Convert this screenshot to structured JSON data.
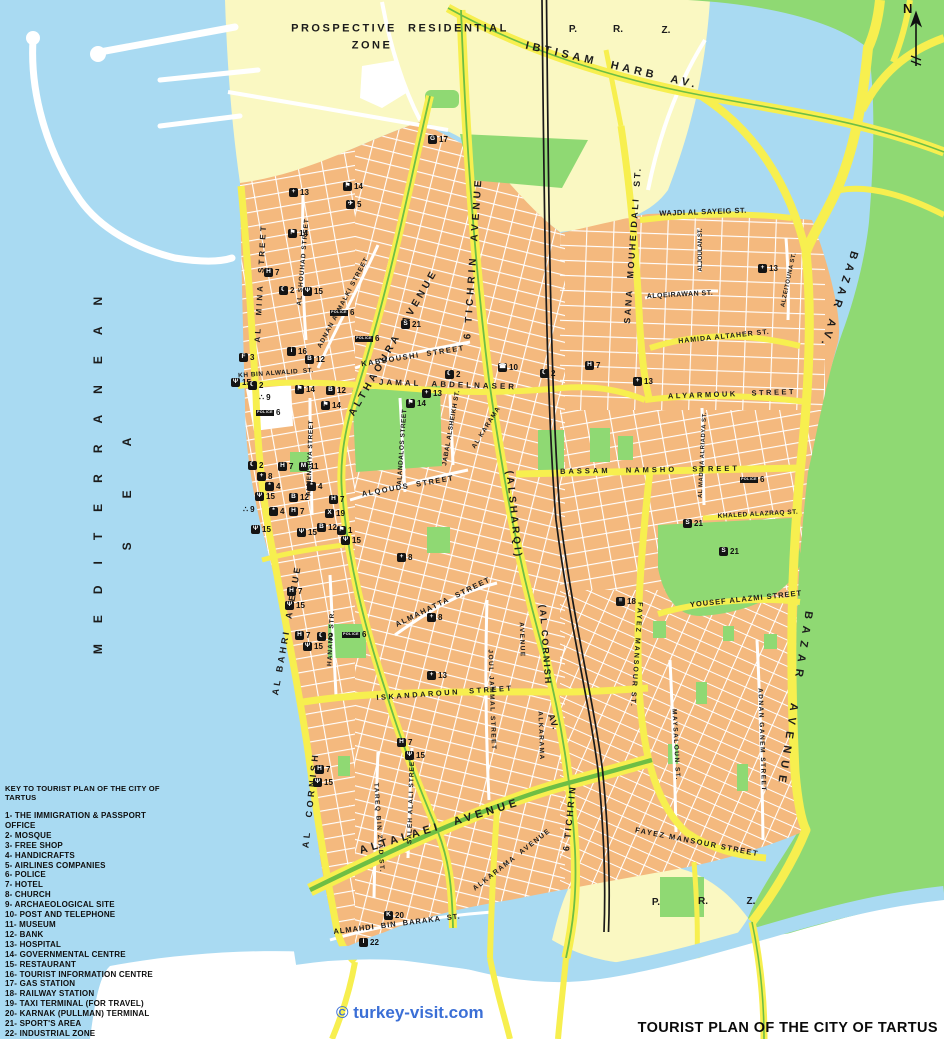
{
  "title": "TOURIST PLAN OF THE CITY OF TARTUS",
  "watermark": "© turkey-visit.com",
  "compass": "N",
  "colors": {
    "sea": "#A9DAF2",
    "sand": "#FAF8C2",
    "green": "#8FD973",
    "city": "#F4B97E",
    "road": "#F7EF4F",
    "median": "#6EBE44",
    "rail": "#1a1a1a",
    "street": "#FFFFFF",
    "watermark": "#3B6FD6"
  },
  "legend": {
    "title": "KEY TO TOURIST PLAN OF THE CITY OF TARTUS",
    "items": [
      "1- THE  IMMIGRATION  &  PASSPORT OFFICE",
      "2- MOSQUE",
      "3- FREE SHOP",
      "4- HANDICRAFTS",
      "5- AIRLINES COMPANIES",
      "6- POLICE",
      "7- HOTEL",
      "8- CHURCH",
      "9- ARCHAEOLOGICAL SITE",
      "10-  POST AND TELEPHONE",
      "11- MUSEUM",
      "12- BANK",
      "13- HOSPITAL",
      "14- GOVERNMENTAL CENTRE",
      "15- RESTAURANT",
      "16- TOURIST INFORMATION CENTRE",
      "17- GAS STATION",
      "18- RAILWAY STATION",
      "19- TAXI TERMINAL (FOR TRAVEL)",
      "20- KARNAK (PULLMAN) TERMINAL",
      "21- SPORT'S AREA",
      "22- INDUSTRIAL ZONE"
    ]
  },
  "poi_glyphs": {
    "1": "⚑",
    "2": "☾",
    "3": "F",
    "4": "*",
    "5": "✈",
    "6": "POLICE",
    "7": "H",
    "8": "+",
    "9": "∴",
    "10": "☎",
    "11": "M",
    "12": "B",
    "13": "+",
    "14": "⚑",
    "15": "Ψ",
    "16": "i",
    "17": "G",
    "18": "≡",
    "19": "X",
    "20": "K",
    "21": "S",
    "22": "I"
  },
  "streets": [
    {
      "label": "PROSPECTIVE  RESIDENTIAL",
      "x": 400,
      "y": 29,
      "rot": 0,
      "fs": 11,
      "ls": 2.5
    },
    {
      "label": "ZONE",
      "x": 372,
      "y": 46,
      "rot": 0,
      "fs": 11,
      "ls": 2.5
    },
    {
      "label": "P.",
      "x": 573,
      "y": 30,
      "rot": 0,
      "fs": 10,
      "ls": 0
    },
    {
      "label": "R.",
      "x": 618,
      "y": 30,
      "rot": 0,
      "fs": 10,
      "ls": 0
    },
    {
      "label": "Z.",
      "x": 666,
      "y": 31,
      "rot": 0,
      "fs": 10,
      "ls": 0
    },
    {
      "label": "P.",
      "x": 656,
      "y": 903,
      "rot": 0,
      "fs": 10,
      "ls": 0
    },
    {
      "label": "R.",
      "x": 703,
      "y": 902,
      "rot": 0,
      "fs": 10,
      "ls": 0
    },
    {
      "label": "Z.",
      "x": 751,
      "y": 902,
      "rot": 0,
      "fs": 10,
      "ls": 0
    },
    {
      "label": "IBTISAM  HARB  AV.",
      "x": 612,
      "y": 66,
      "rot": 13,
      "fs": 11,
      "ls": 4
    },
    {
      "label": "MEDITERRANEAN",
      "x": 98,
      "y": 465,
      "rot": -90,
      "fs": 12,
      "ls": 21
    },
    {
      "label": "SEA",
      "x": 127,
      "y": 472,
      "rot": -90,
      "fs": 12,
      "ls": 44
    },
    {
      "label": "AL  MINA  STREET",
      "x": 261,
      "y": 283,
      "rot": -87,
      "fs": 8,
      "ls": 3
    },
    {
      "label": "AL SHOUHAD STREET",
      "x": 304,
      "y": 262,
      "rot": -85,
      "fs": 6.5,
      "ls": 1
    },
    {
      "label": "ADNAN ALMALKI STREET",
      "x": 344,
      "y": 303,
      "rot": -62,
      "fs": 6.5,
      "ls": 1
    },
    {
      "label": "ALTHAOURA  AVENUE",
      "x": 394,
      "y": 343,
      "rot": -60,
      "fs": 10,
      "ls": 3.5
    },
    {
      "label": "6 TICHRIN  AVENUE",
      "x": 474,
      "y": 258,
      "rot": -86,
      "fs": 10,
      "ls": 4
    },
    {
      "label": "SANA  MOUHEIDALI  ST.",
      "x": 633,
      "y": 245,
      "rot": -86,
      "fs": 9,
      "ls": 2.5
    },
    {
      "label": "WAJDI AL SAYEIG ST.",
      "x": 703,
      "y": 212,
      "rot": -2,
      "fs": 7.5,
      "ls": 0.5
    },
    {
      "label": "ALJOULAN ST.",
      "x": 701,
      "y": 250,
      "rot": -90,
      "fs": 6,
      "ls": 0
    },
    {
      "label": "ALQEIRAWAN ST.",
      "x": 680,
      "y": 295,
      "rot": -3,
      "fs": 7,
      "ls": 0.5
    },
    {
      "label": "HAMIDA ALTAHER ST.",
      "x": 724,
      "y": 337,
      "rot": -6,
      "fs": 7,
      "ls": 1
    },
    {
      "label": "ALZEITOUNA ST.",
      "x": 789,
      "y": 280,
      "rot": -78,
      "fs": 6,
      "ls": 0.5
    },
    {
      "label": "BAZAR AV.",
      "x": 838,
      "y": 300,
      "rot": 108,
      "fs": 11,
      "ls": 5
    },
    {
      "label": "BAZAR  AVENUE",
      "x": 794,
      "y": 700,
      "rot": 99,
      "fs": 11,
      "ls": 7
    },
    {
      "label": "ALYARMOUK   STREET",
      "x": 732,
      "y": 394,
      "rot": -2,
      "fs": 7.5,
      "ls": 2.5
    },
    {
      "label": "BASSAM   NAMSHO   STREET",
      "x": 650,
      "y": 470,
      "rot": -1,
      "fs": 7.5,
      "ls": 3
    },
    {
      "label": "AL MADINA ALRIADYA ST.",
      "x": 703,
      "y": 455,
      "rot": -87,
      "fs": 6,
      "ls": 0.5
    },
    {
      "label": "KHALED ALAZRAQ ST.",
      "x": 758,
      "y": 515,
      "rot": -3,
      "fs": 6.5,
      "ls": 0.5
    },
    {
      "label": "YOUSEF ALAZMI STREET",
      "x": 746,
      "y": 599,
      "rot": -6,
      "fs": 7.5,
      "ls": 1
    },
    {
      "label": "FAYEZ MANSOUR ST.",
      "x": 636,
      "y": 655,
      "rot": 94,
      "fs": 7,
      "ls": 2
    },
    {
      "label": "FAYEZ MANSOUR STREET",
      "x": 697,
      "y": 842,
      "rot": 11,
      "fs": 7.5,
      "ls": 1.5
    },
    {
      "label": "MAYSALOUN ST.",
      "x": 675,
      "y": 745,
      "rot": 87,
      "fs": 6.5,
      "ls": 1.5
    },
    {
      "label": "ADNAN GANEM STREET",
      "x": 761,
      "y": 740,
      "rot": 88,
      "fs": 6.5,
      "ls": 1.5
    },
    {
      "label": "ALMAHATTA  STREET",
      "x": 443,
      "y": 602,
      "rot": -26,
      "fs": 7.5,
      "ls": 1.5
    },
    {
      "label": "ISKANDAROUN  STREET",
      "x": 445,
      "y": 693,
      "rot": -4,
      "fs": 7.5,
      "ls": 2.5
    },
    {
      "label": "JOUL JAMMAL STREET",
      "x": 491,
      "y": 700,
      "rot": 88,
      "fs": 6.5,
      "ls": 1.5
    },
    {
      "label": "AVENUE",
      "x": 521,
      "y": 640,
      "rot": 88,
      "fs": 6.5,
      "ls": 1.5
    },
    {
      "label": "ALKARAMA",
      "x": 540,
      "y": 736,
      "rot": 88,
      "fs": 6.5,
      "ls": 1.5
    },
    {
      "label": "(ALSHARQI)",
      "x": 513,
      "y": 515,
      "rot": 84,
      "fs": 10,
      "ls": 3
    },
    {
      "label": "(AL CORNISH",
      "x": 545,
      "y": 645,
      "rot": 86,
      "fs": 9,
      "ls": 2
    },
    {
      "label": "AV.",
      "x": 553,
      "y": 722,
      "rot": 70,
      "fs": 9,
      "ls": 1
    },
    {
      "label": "6 TICHRIN",
      "x": 570,
      "y": 818,
      "rot": -84,
      "fs": 9,
      "ls": 2.5
    },
    {
      "label": "ALKARAMA  AVENUE",
      "x": 512,
      "y": 860,
      "rot": -38,
      "fs": 7,
      "ls": 1.5
    },
    {
      "label": "ALTALAEI  AVENUE",
      "x": 440,
      "y": 827,
      "rot": -17,
      "fs": 11,
      "ls": 4
    },
    {
      "label": "AL BAHRI  AVENUE",
      "x": 287,
      "y": 630,
      "rot": -80,
      "fs": 9,
      "ls": 3
    },
    {
      "label": "AL  CORNISH",
      "x": 311,
      "y": 800,
      "rot": -84,
      "fs": 9,
      "ls": 3.5
    },
    {
      "label": "HANANO STR.",
      "x": 332,
      "y": 638,
      "rot": -87,
      "fs": 6.5,
      "ls": 1
    },
    {
      "label": "TAREQ BIN ZIAD ST.",
      "x": 378,
      "y": 828,
      "rot": 86,
      "fs": 6.5,
      "ls": 1.5
    },
    {
      "label": "SALEH ALALI STREET",
      "x": 412,
      "y": 800,
      "rot": -88,
      "fs": 6.5,
      "ls": 1
    },
    {
      "label": "ALMENSHYA STREET",
      "x": 311,
      "y": 458,
      "rot": -88,
      "fs": 6.5,
      "ls": 0.5
    },
    {
      "label": "KH BIN ALWALID  ST.",
      "x": 276,
      "y": 374,
      "rot": -4,
      "fs": 6.5,
      "ls": 0.5
    },
    {
      "label": "JAMAL  ABDELNASER",
      "x": 448,
      "y": 385,
      "rot": 2,
      "fs": 8,
      "ls": 3
    },
    {
      "label": "KABBOUSHI  STREET",
      "x": 413,
      "y": 356,
      "rot": -9,
      "fs": 7.5,
      "ls": 1.5
    },
    {
      "label": "ALQOUDS  STREET",
      "x": 408,
      "y": 486,
      "rot": -10,
      "fs": 7.5,
      "ls": 1.5
    },
    {
      "label": "ALANDALOS STREET",
      "x": 403,
      "y": 447,
      "rot": -86,
      "fs": 6.5,
      "ls": 0.5
    },
    {
      "label": "JABAL ALSHEIKH ST.",
      "x": 452,
      "y": 428,
      "rot": -80,
      "fs": 6.5,
      "ls": 0.5
    },
    {
      "label": "AL KARAMA",
      "x": 487,
      "y": 428,
      "rot": -58,
      "fs": 6.5,
      "ls": 1
    },
    {
      "label": "ALMAHDI  BIN  BARAKA  ST.",
      "x": 397,
      "y": 924,
      "rot": -7,
      "fs": 7.5,
      "ls": 1
    }
  ],
  "pois": [
    {
      "n": 17,
      "x": 428,
      "y": 140
    },
    {
      "n": 13,
      "x": 289,
      "y": 193
    },
    {
      "n": 14,
      "x": 343,
      "y": 187
    },
    {
      "n": 5,
      "x": 346,
      "y": 205
    },
    {
      "n": 14,
      "x": 288,
      "y": 234
    },
    {
      "n": 7,
      "x": 264,
      "y": 273
    },
    {
      "n": 2,
      "x": 279,
      "y": 291
    },
    {
      "n": 15,
      "x": 303,
      "y": 292
    },
    {
      "n": 6,
      "x": 330,
      "y": 314
    },
    {
      "n": 21,
      "x": 401,
      "y": 325
    },
    {
      "n": 6,
      "x": 355,
      "y": 340
    },
    {
      "n": 3,
      "x": 239,
      "y": 358
    },
    {
      "n": 16,
      "x": 287,
      "y": 352
    },
    {
      "n": 12,
      "x": 305,
      "y": 360
    },
    {
      "n": 15,
      "x": 231,
      "y": 383
    },
    {
      "n": 2,
      "x": 248,
      "y": 386
    },
    {
      "n": 9,
      "x": 259,
      "y": 399
    },
    {
      "n": 6,
      "x": 256,
      "y": 414
    },
    {
      "n": 14,
      "x": 295,
      "y": 390
    },
    {
      "n": 12,
      "x": 326,
      "y": 391
    },
    {
      "n": 14,
      "x": 321,
      "y": 406
    },
    {
      "n": 10,
      "x": 498,
      "y": 368
    },
    {
      "n": 2,
      "x": 445,
      "y": 375
    },
    {
      "n": 13,
      "x": 422,
      "y": 394
    },
    {
      "n": 14,
      "x": 406,
      "y": 404
    },
    {
      "n": 2,
      "x": 540,
      "y": 374
    },
    {
      "n": 7,
      "x": 585,
      "y": 366
    },
    {
      "n": 13,
      "x": 758,
      "y": 269
    },
    {
      "n": 13,
      "x": 633,
      "y": 382
    },
    {
      "n": 6,
      "x": 740,
      "y": 481
    },
    {
      "n": 21,
      "x": 683,
      "y": 524
    },
    {
      "n": 21,
      "x": 719,
      "y": 552
    },
    {
      "n": 18,
      "x": 616,
      "y": 602
    },
    {
      "n": 8,
      "x": 397,
      "y": 558
    },
    {
      "n": 8,
      "x": 427,
      "y": 618
    },
    {
      "n": 13,
      "x": 427,
      "y": 676
    },
    {
      "n": 7,
      "x": 287,
      "y": 592
    },
    {
      "n": 15,
      "x": 285,
      "y": 606
    },
    {
      "n": 7,
      "x": 295,
      "y": 636
    },
    {
      "n": 2,
      "x": 317,
      "y": 637
    },
    {
      "n": 15,
      "x": 303,
      "y": 647
    },
    {
      "n": 6,
      "x": 342,
      "y": 636
    },
    {
      "n": 7,
      "x": 315,
      "y": 770
    },
    {
      "n": 15,
      "x": 313,
      "y": 783
    },
    {
      "n": 7,
      "x": 397,
      "y": 743
    },
    {
      "n": 15,
      "x": 405,
      "y": 756
    },
    {
      "n": 20,
      "x": 384,
      "y": 916
    },
    {
      "n": 22,
      "x": 359,
      "y": 943
    },
    {
      "n": 11,
      "x": 299,
      "y": 467
    },
    {
      "n": 7,
      "x": 278,
      "y": 467
    },
    {
      "n": 2,
      "x": 248,
      "y": 466
    },
    {
      "n": 8,
      "x": 257,
      "y": 477
    },
    {
      "n": 4,
      "x": 265,
      "y": 487
    },
    {
      "n": 4,
      "x": 307,
      "y": 487
    },
    {
      "n": 15,
      "x": 255,
      "y": 497
    },
    {
      "n": 12,
      "x": 289,
      "y": 498
    },
    {
      "n": 7,
      "x": 329,
      "y": 500
    },
    {
      "n": 9,
      "x": 243,
      "y": 511
    },
    {
      "n": 4,
      "x": 269,
      "y": 512
    },
    {
      "n": 7,
      "x": 289,
      "y": 512
    },
    {
      "n": 19,
      "x": 325,
      "y": 514
    },
    {
      "n": 15,
      "x": 251,
      "y": 530
    },
    {
      "n": 12,
      "x": 317,
      "y": 528
    },
    {
      "n": 1,
      "x": 337,
      "y": 531
    },
    {
      "n": 15,
      "x": 297,
      "y": 533
    },
    {
      "n": 15,
      "x": 341,
      "y": 541
    }
  ]
}
